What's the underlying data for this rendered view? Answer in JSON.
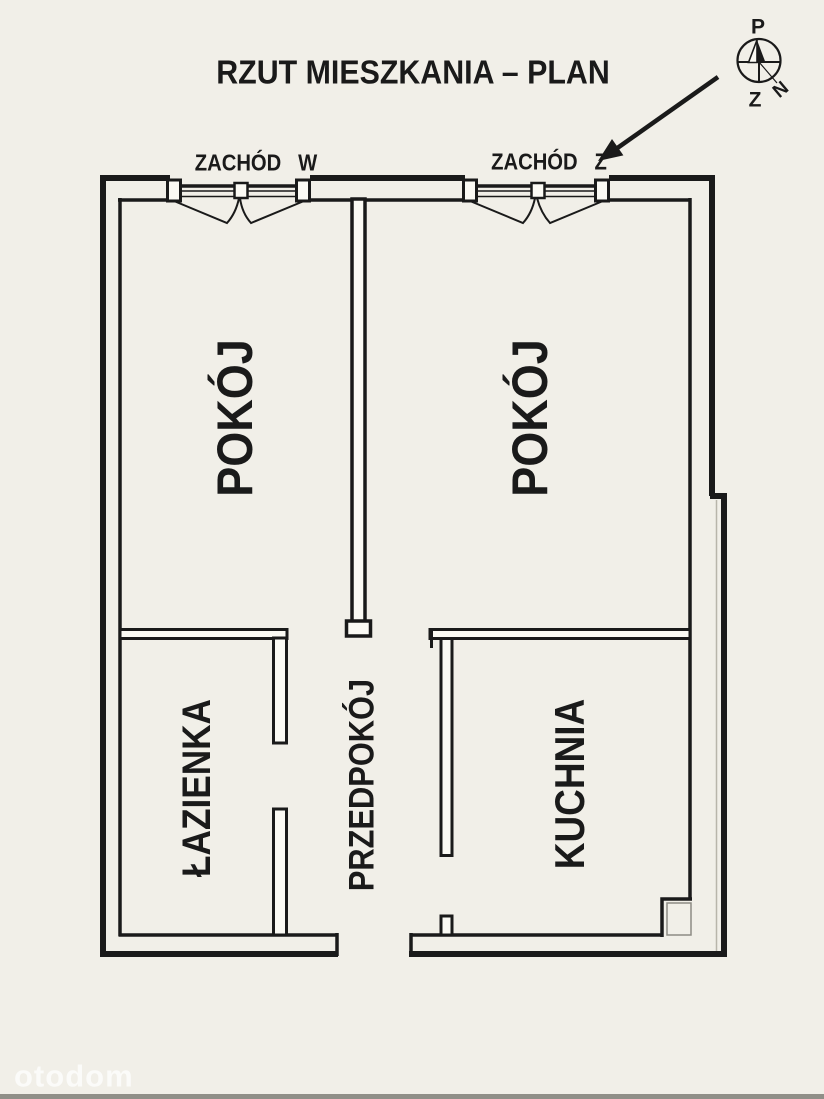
{
  "colors": {
    "background": "#f1efe8",
    "line": "#1a1a1a",
    "wall_fill": "#fbfaf4",
    "watermark": "#ffffff",
    "shadow_line": "#b8b5aa"
  },
  "title": {
    "text": "RZUT MIESZKANIA – PLAN"
  },
  "compass": {
    "p": "P",
    "z": "Z",
    "n": "N"
  },
  "window_labels": {
    "left": "ZACHÓD   W",
    "right": "ZACHÓD   Z"
  },
  "rooms": {
    "room_left": "POKÓJ",
    "room_right": "POKÓJ",
    "bathroom": "ŁAZIENKA",
    "hallway": "PRZEDPOKÓJ",
    "kitchen": "KUCHNIA"
  },
  "watermark": "otodom"
}
